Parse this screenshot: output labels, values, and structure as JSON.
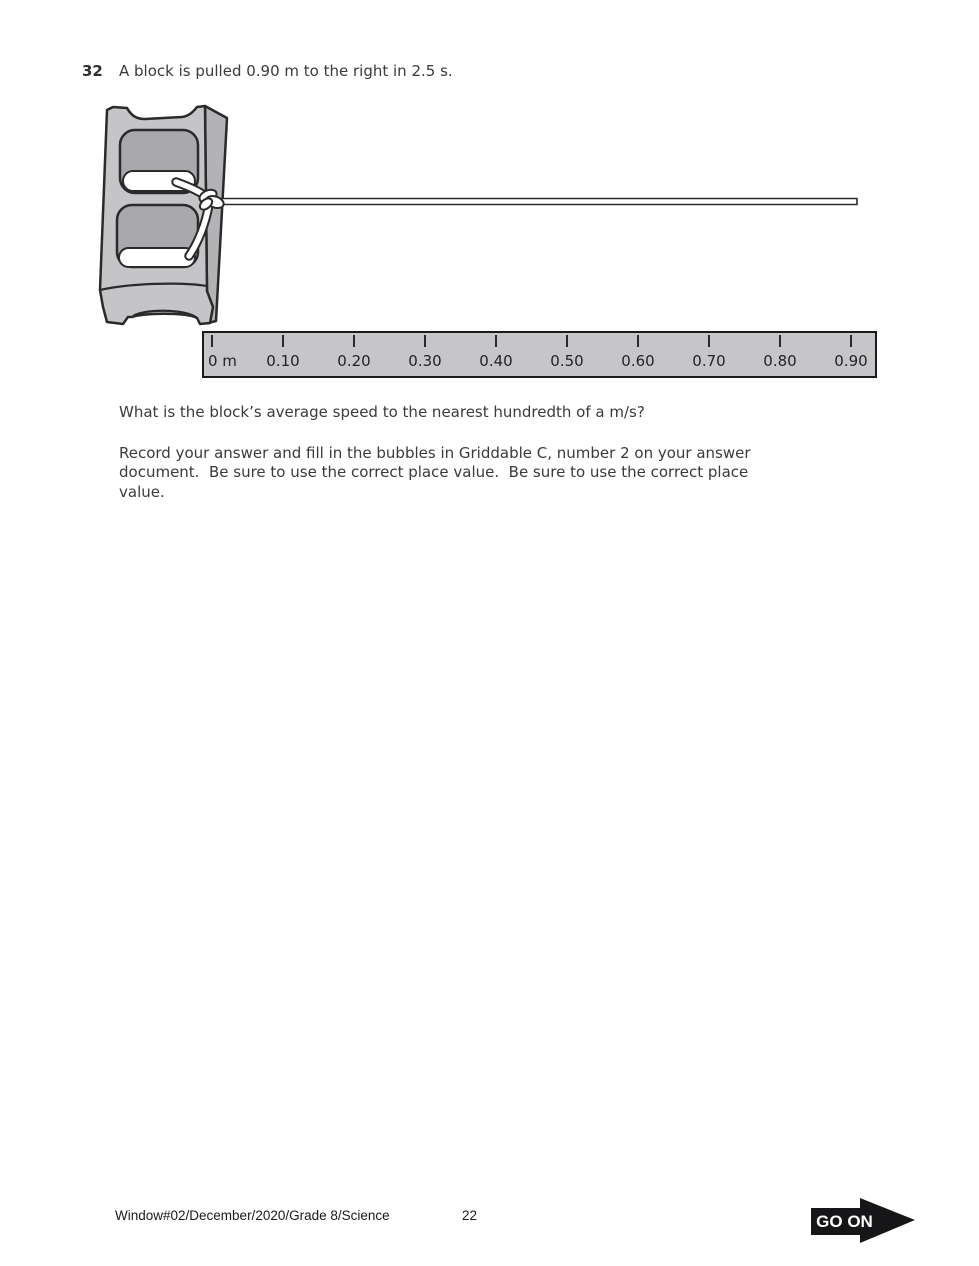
{
  "question": {
    "number": "32",
    "intro": "A block is pulled 0.90 m to the right in 2.5 s.",
    "prompt": "What is the block’s average speed to the nearest hundredth of a m/s?",
    "instructions_lines": [
      "Record your answer and fill in the bubbles in Griddable C, number 2 on your answer",
      "document.  Be sure to use the correct place value.  Be sure to use the correct place",
      "value."
    ]
  },
  "figure": {
    "block_icon": "cinder-block-with-rope",
    "ruler": {
      "unit_labels": [
        "0 m",
        "0.10",
        "0.20",
        "0.30",
        "0.40",
        "0.50",
        "0.60",
        "0.70",
        "0.80",
        "0.90"
      ],
      "tick_spacing_px": 71,
      "first_tick_px": 8
    }
  },
  "footer": {
    "document_id": "Window#02/December/2020/Grade 8/Science",
    "page_number": "22",
    "go_on_label": "GO ON"
  },
  "colors": {
    "block_face": "#c5c5c7",
    "block_side": "#b3b3b5",
    "block_hole": "#a9a9ab",
    "outline": "#2a2a2c",
    "ruler_fill": "#c6c6c8",
    "go_on_bg": "#161618"
  }
}
